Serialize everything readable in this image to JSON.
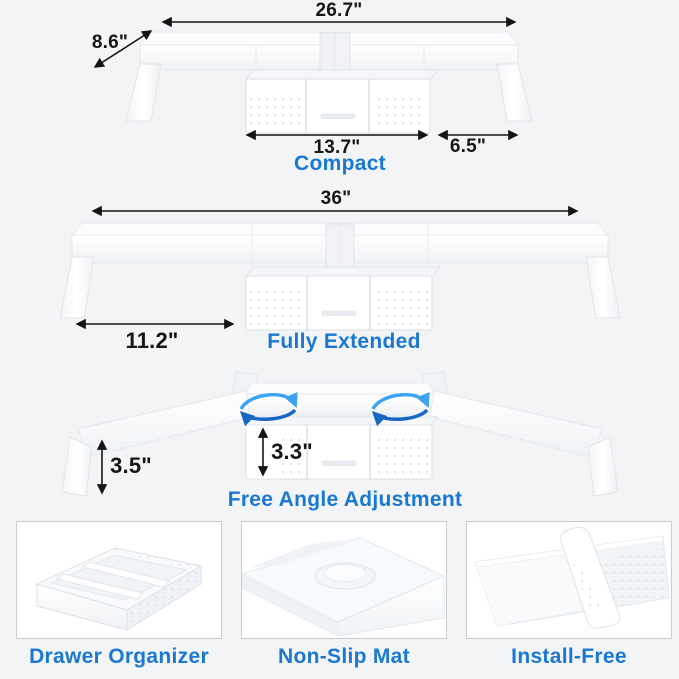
{
  "accent": "#1b78d2",
  "sections": {
    "compact": {
      "label": "Compact",
      "dim_width": "26.7\"",
      "dim_depth": "8.6\"",
      "dim_drawer": "13.7\"",
      "dim_side": "6.5\""
    },
    "extended": {
      "label": "Fully Extended",
      "dim_width": "36\"",
      "dim_extension": "11.2\""
    },
    "angle": {
      "label": "Free Angle Adjustment",
      "dim_leg_height": "3.5\"",
      "dim_drawer_height": "3.3\""
    }
  },
  "features": [
    {
      "label": "Drawer Organizer"
    },
    {
      "label": "Non-Slip Mat"
    },
    {
      "label": "Install-Free"
    }
  ]
}
